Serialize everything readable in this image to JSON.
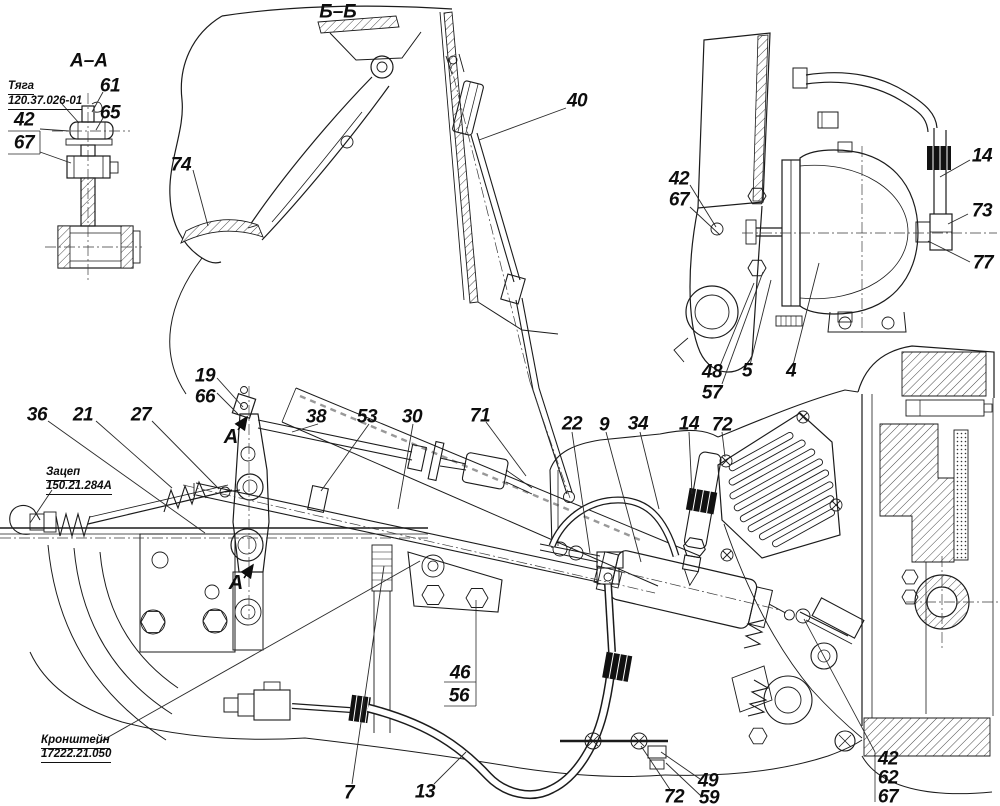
{
  "meta": {
    "background_color": "#ffffff",
    "line_color": "#1b1b1b",
    "label_color": "#0d0d0d",
    "drawing_type": "clutch control linkage assembly drawing"
  },
  "sections": {
    "aa": "А–А",
    "bb": "Б–Б"
  },
  "view_arrow": {
    "letter": "А"
  },
  "labels": {
    "tyaga": {
      "name": "Тяга",
      "number": "120.37.026-01"
    },
    "zacep": {
      "name": "Зацеп",
      "number": "150.21.284А"
    },
    "kronshtein": {
      "name": "Кронштейн",
      "number": "17222.21.050"
    }
  },
  "callouts": {
    "c61": {
      "n": "61"
    },
    "c65": {
      "n": "65"
    },
    "c42a": {
      "n": "42"
    },
    "c67a": {
      "n": "67"
    },
    "c74": {
      "n": "74"
    },
    "c40": {
      "n": "40"
    },
    "c42b": {
      "n": "42"
    },
    "c67b": {
      "n": "67"
    },
    "c14b": {
      "n": "14"
    },
    "c73": {
      "n": "73"
    },
    "c77": {
      "n": "77"
    },
    "c48": {
      "n": "48"
    },
    "c57": {
      "n": "57"
    },
    "c5": {
      "n": "5"
    },
    "c4": {
      "n": "4"
    },
    "c19": {
      "n": "19"
    },
    "c66": {
      "n": "66"
    },
    "c36": {
      "n": "36"
    },
    "c21": {
      "n": "21"
    },
    "c27": {
      "n": "27"
    },
    "c38": {
      "n": "38"
    },
    "c53": {
      "n": "53"
    },
    "c30": {
      "n": "30"
    },
    "c71": {
      "n": "71"
    },
    "c22": {
      "n": "22"
    },
    "c9": {
      "n": "9"
    },
    "c34": {
      "n": "34"
    },
    "c14c": {
      "n": "14"
    },
    "c72a": {
      "n": "72"
    },
    "c46": {
      "n": "46"
    },
    "c56": {
      "n": "56"
    },
    "c7": {
      "n": "7"
    },
    "c13": {
      "n": "13"
    },
    "c72b": {
      "n": "72"
    },
    "c49": {
      "n": "49"
    },
    "c59": {
      "n": "59"
    },
    "c42c": {
      "n": "42"
    },
    "c62": {
      "n": "62"
    },
    "c67c": {
      "n": "67"
    }
  }
}
